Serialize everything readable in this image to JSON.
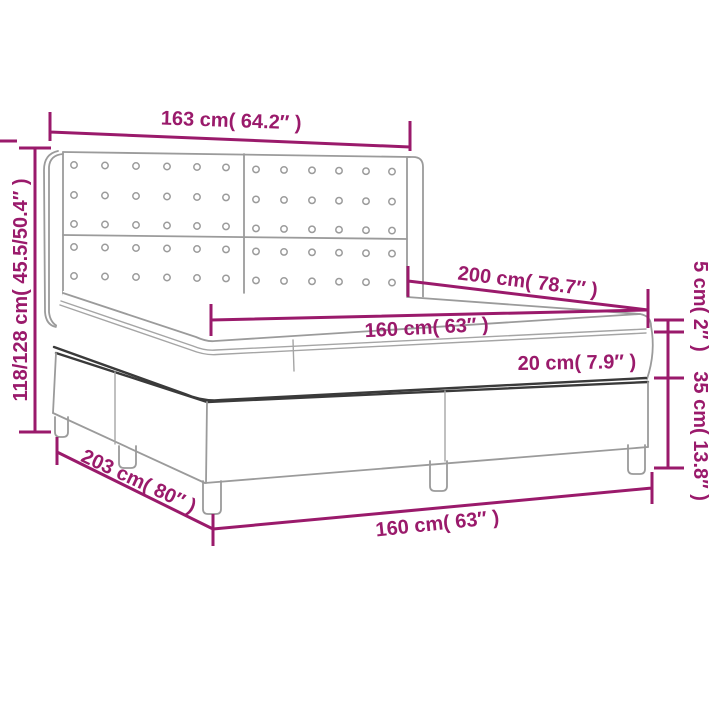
{
  "diagram": {
    "product": "box-spring-bed-with-headboard",
    "dimensions": {
      "headboard_width": "163 cm( 64.2″ )",
      "frame_height_range": "118/128 cm( 45.5/50.4″ )",
      "bed_length": "200 cm( 78.7″ )",
      "mattress_width": "160 cm( 63″ )",
      "mattress_height": "20 cm( 7.9″ )",
      "topper_height": "5 cm( 2″ )",
      "base_height": "35 cm( 13.8″ )",
      "base_length": "203 cm( 80″ )",
      "base_width": "160 cm( 63″ )"
    },
    "colors": {
      "dimension_accent": "#9A1A6B",
      "outline_light": "#9B9B9B",
      "outline_dark": "#3A3A3A",
      "background": "#FFFFFF"
    }
  }
}
